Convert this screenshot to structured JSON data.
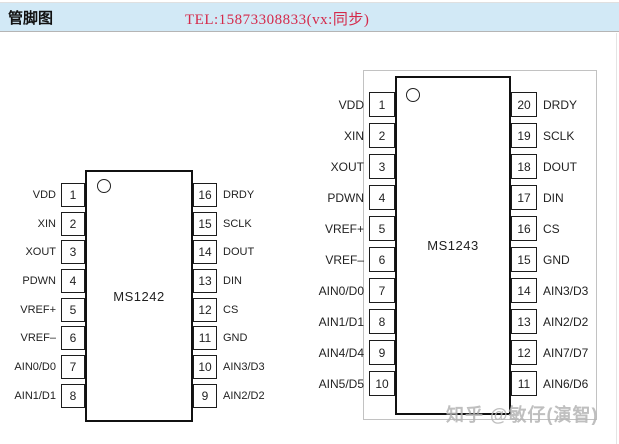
{
  "header": {
    "title": "管脚图",
    "tel": "TEL:15873308833(vx:同步)",
    "bar_color": "#d2e9f6",
    "tel_color": "#d4294a"
  },
  "watermark": "知乎 @敏仔(演智)",
  "chips": [
    {
      "name": "MS1242",
      "left_pins": [
        {
          "num": "1",
          "label": "VDD"
        },
        {
          "num": "2",
          "label": "XIN"
        },
        {
          "num": "3",
          "label": "XOUT"
        },
        {
          "num": "4",
          "label": "PDWN"
        },
        {
          "num": "5",
          "label": "VREF+"
        },
        {
          "num": "6",
          "label": "VREF–"
        },
        {
          "num": "7",
          "label": "AIN0/D0"
        },
        {
          "num": "8",
          "label": "AIN1/D1"
        }
      ],
      "right_pins": [
        {
          "num": "16",
          "label": "DRDY"
        },
        {
          "num": "15",
          "label": "SCLK"
        },
        {
          "num": "14",
          "label": "DOUT"
        },
        {
          "num": "13",
          "label": "DIN"
        },
        {
          "num": "12",
          "label": "CS"
        },
        {
          "num": "11",
          "label": "GND"
        },
        {
          "num": "10",
          "label": "AIN3/D3"
        },
        {
          "num": "9",
          "label": "AIN2/D2"
        }
      ]
    },
    {
      "name": "MS1243",
      "left_pins": [
        {
          "num": "1",
          "label": "VDD"
        },
        {
          "num": "2",
          "label": "XIN"
        },
        {
          "num": "3",
          "label": "XOUT"
        },
        {
          "num": "4",
          "label": "PDWN"
        },
        {
          "num": "5",
          "label": "VREF+"
        },
        {
          "num": "6",
          "label": "VREF–"
        },
        {
          "num": "7",
          "label": "AIN0/D0"
        },
        {
          "num": "8",
          "label": "AIN1/D1"
        },
        {
          "num": "9",
          "label": "AIN4/D4"
        },
        {
          "num": "10",
          "label": "AIN5/D5"
        }
      ],
      "right_pins": [
        {
          "num": "20",
          "label": "DRDY"
        },
        {
          "num": "19",
          "label": "SCLK"
        },
        {
          "num": "18",
          "label": "DOUT"
        },
        {
          "num": "17",
          "label": "DIN"
        },
        {
          "num": "16",
          "label": "CS"
        },
        {
          "num": "15",
          "label": "GND"
        },
        {
          "num": "14",
          "label": "AIN3/D3"
        },
        {
          "num": "13",
          "label": "AIN2/D2"
        },
        {
          "num": "12",
          "label": "AIN7/D7"
        },
        {
          "num": "11",
          "label": "AIN6/D6"
        }
      ]
    }
  ]
}
